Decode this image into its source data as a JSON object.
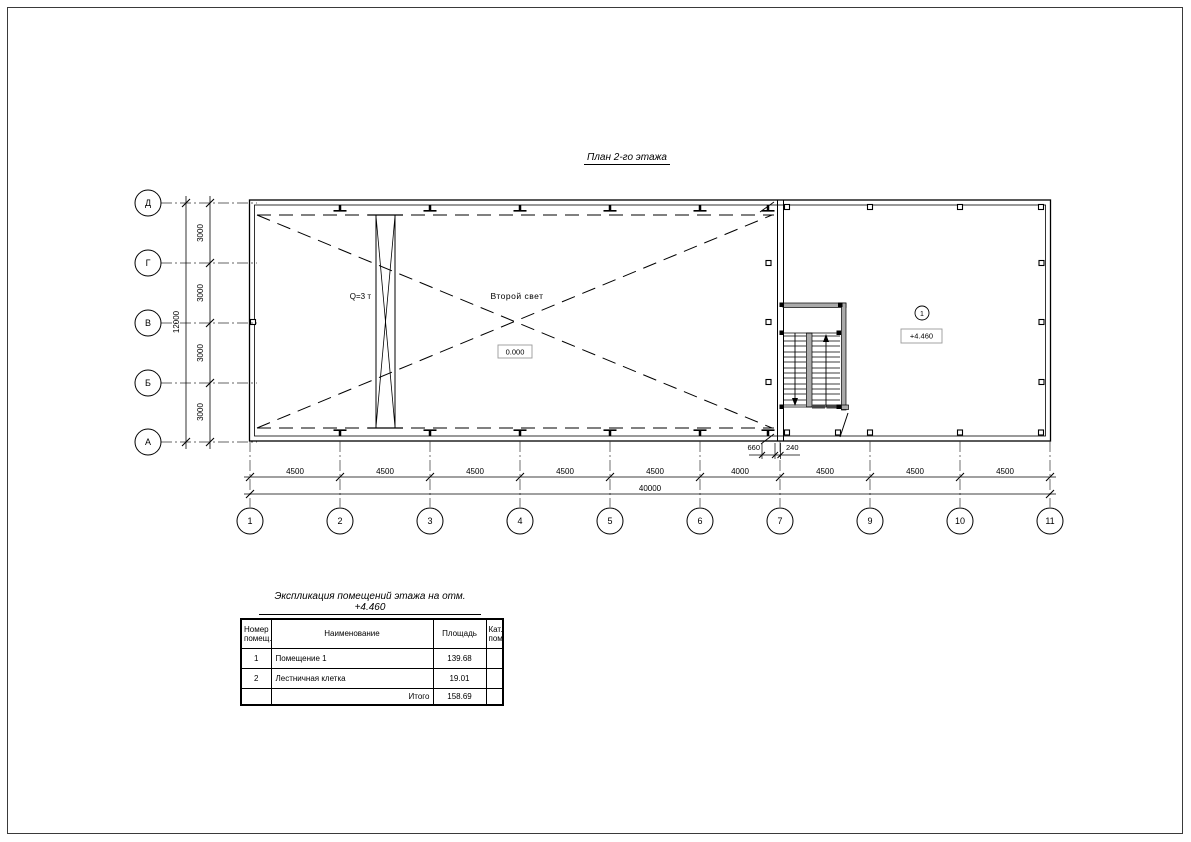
{
  "sheet": {
    "title": "План 2-го этажа"
  },
  "plan": {
    "crane_label": "Q=3 т",
    "void_label": "Второй свет",
    "ground_level_mark": "0.000",
    "room_tag_number": "1",
    "room_level_mark": "+4.460"
  },
  "axes": {
    "bottom": [
      "1",
      "2",
      "3",
      "4",
      "5",
      "6",
      "7",
      "9",
      "10",
      "11"
    ],
    "left": [
      "Д",
      "Г",
      "В",
      "Б",
      "А"
    ]
  },
  "dims": {
    "bottom_segments": [
      "4500",
      "4500",
      "4500",
      "4500",
      "4500",
      "4000",
      "4500",
      "4500",
      "4500"
    ],
    "bottom_total": "40000",
    "left_segments": [
      "3000",
      "3000",
      "3000",
      "3000"
    ],
    "left_total": "12000",
    "offset_left": "660",
    "offset_right": "240"
  },
  "table": {
    "title": "Экспликация помещений этажа на отм. +4.460",
    "headers": {
      "number_l1": "Номер",
      "number_l2": "помещ.",
      "name": "Наименование",
      "area": "Площадь",
      "cat_l1": "Кат.",
      "cat_l2": "пом."
    },
    "rows": [
      {
        "number": "1",
        "name": "Помещение 1",
        "area": "139.68",
        "cat": ""
      },
      {
        "number": "2",
        "name": "Лестничная клетка",
        "area": "19.01",
        "cat": ""
      }
    ],
    "total_label": "Итого",
    "total_value": "158.69"
  }
}
